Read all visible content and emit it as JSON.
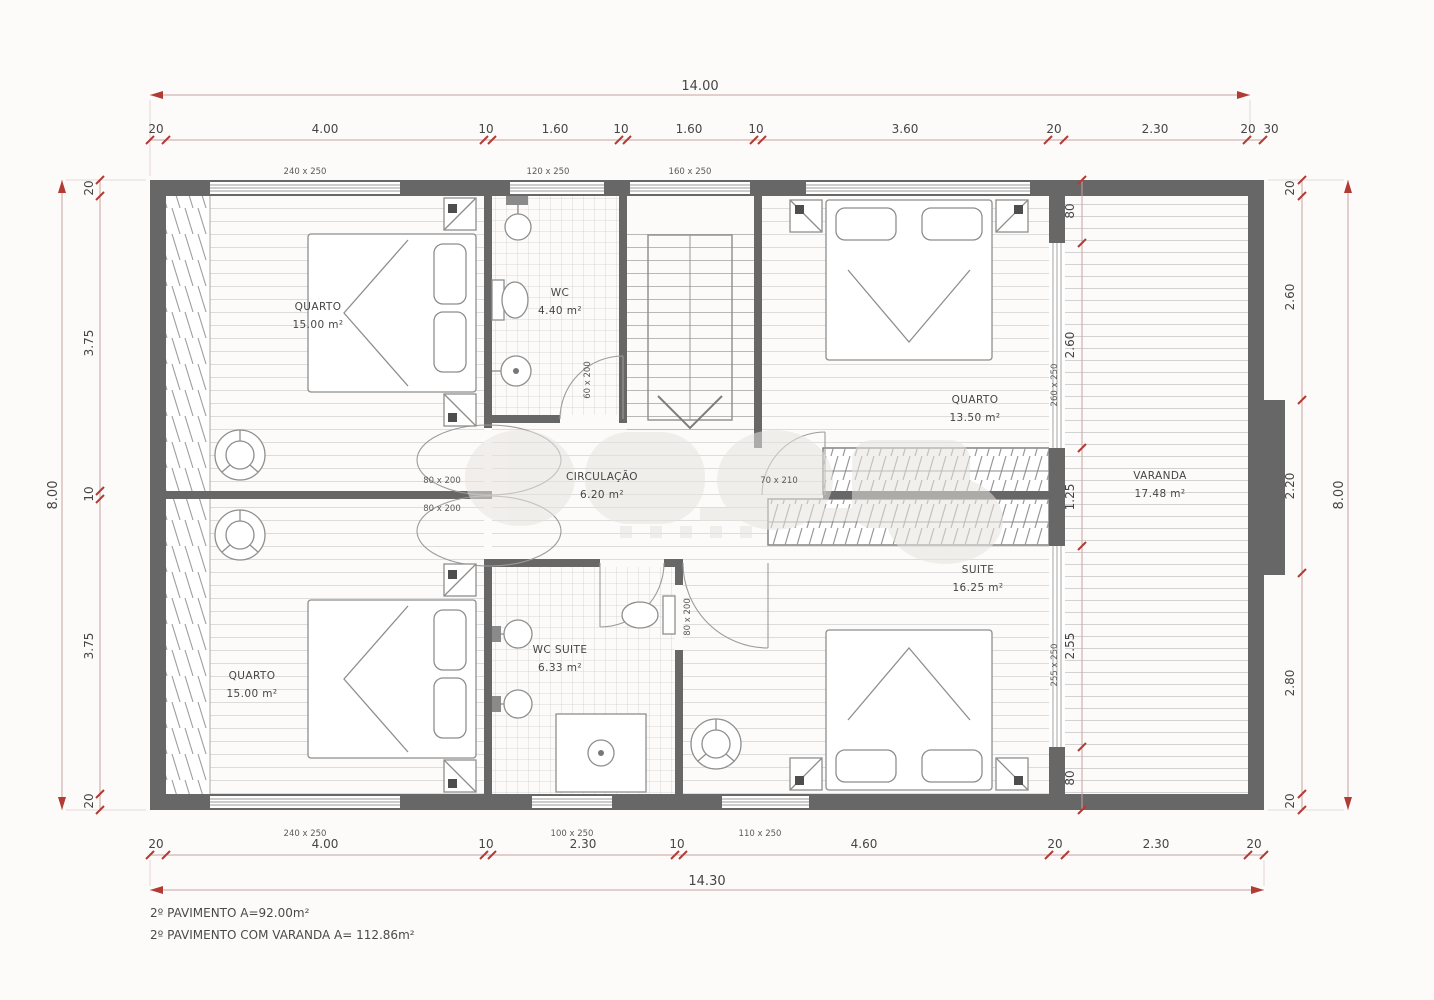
{
  "rooms": {
    "quarto1": {
      "name": "QUARTO",
      "area": "15.00 m²"
    },
    "wc": {
      "name": "WC",
      "area": "4.40 m²"
    },
    "quarto2": {
      "name": "QUARTO",
      "area": "13.50 m²"
    },
    "varanda": {
      "name": "VARANDA",
      "area": "17.48 m²"
    },
    "suite": {
      "name": "SUITE",
      "area": "16.25 m²"
    },
    "quarto3": {
      "name": "QUARTO",
      "area": "15.00 m²"
    },
    "wc_suite": {
      "name": "WC SUITE",
      "area": "6.33 m²"
    },
    "circulacao": {
      "name": "CIRCULAÇÃO",
      "area": "6.20 m²"
    }
  },
  "dims": {
    "top_total": "14.00",
    "bottom_total": "14.30",
    "left_total": "8.00",
    "right_total": "8.00",
    "top": [
      "20",
      "4.00",
      "10",
      "1.60",
      "10",
      "1.60",
      "10",
      "3.60",
      "20",
      "2.30",
      "20",
      "30"
    ],
    "bottom": [
      "20",
      "4.00",
      "10",
      "2.30",
      "10",
      "4.60",
      "20",
      "2.30",
      "20"
    ],
    "left": [
      "20",
      "3.75",
      "10",
      "3.75",
      "20"
    ],
    "right_inner": [
      "80",
      "2.60",
      "1.25",
      "2.55",
      "80"
    ],
    "right_outer": [
      "20",
      "2.60",
      "2.20",
      "2.80",
      "20"
    ]
  },
  "openings": {
    "top_windows": [
      "240 x 250",
      "120 x 250",
      "160 x 250"
    ],
    "bottom_windows": [
      "240 x 250",
      "100 x 250",
      "110 x 250"
    ],
    "right_windows": [
      "260 x 250",
      "255 x 250"
    ],
    "door_quarto1": "80 x 200",
    "door_quarto3": "80 x 200",
    "door_wc": "60 x 200",
    "door_wc_suite": "80 x 200",
    "door_quarto2": "70 x 210"
  },
  "footer": {
    "line1": "2º PAVIMENTO A=92.00m²",
    "line2": "2º PAVIMENTO COM VARANDA A= 112.86m²"
  },
  "colors": {
    "wall": "#676767",
    "dimension_line": "#c9a0a0",
    "tick": "#b23b34",
    "floor_line": "#dcdcdc"
  }
}
